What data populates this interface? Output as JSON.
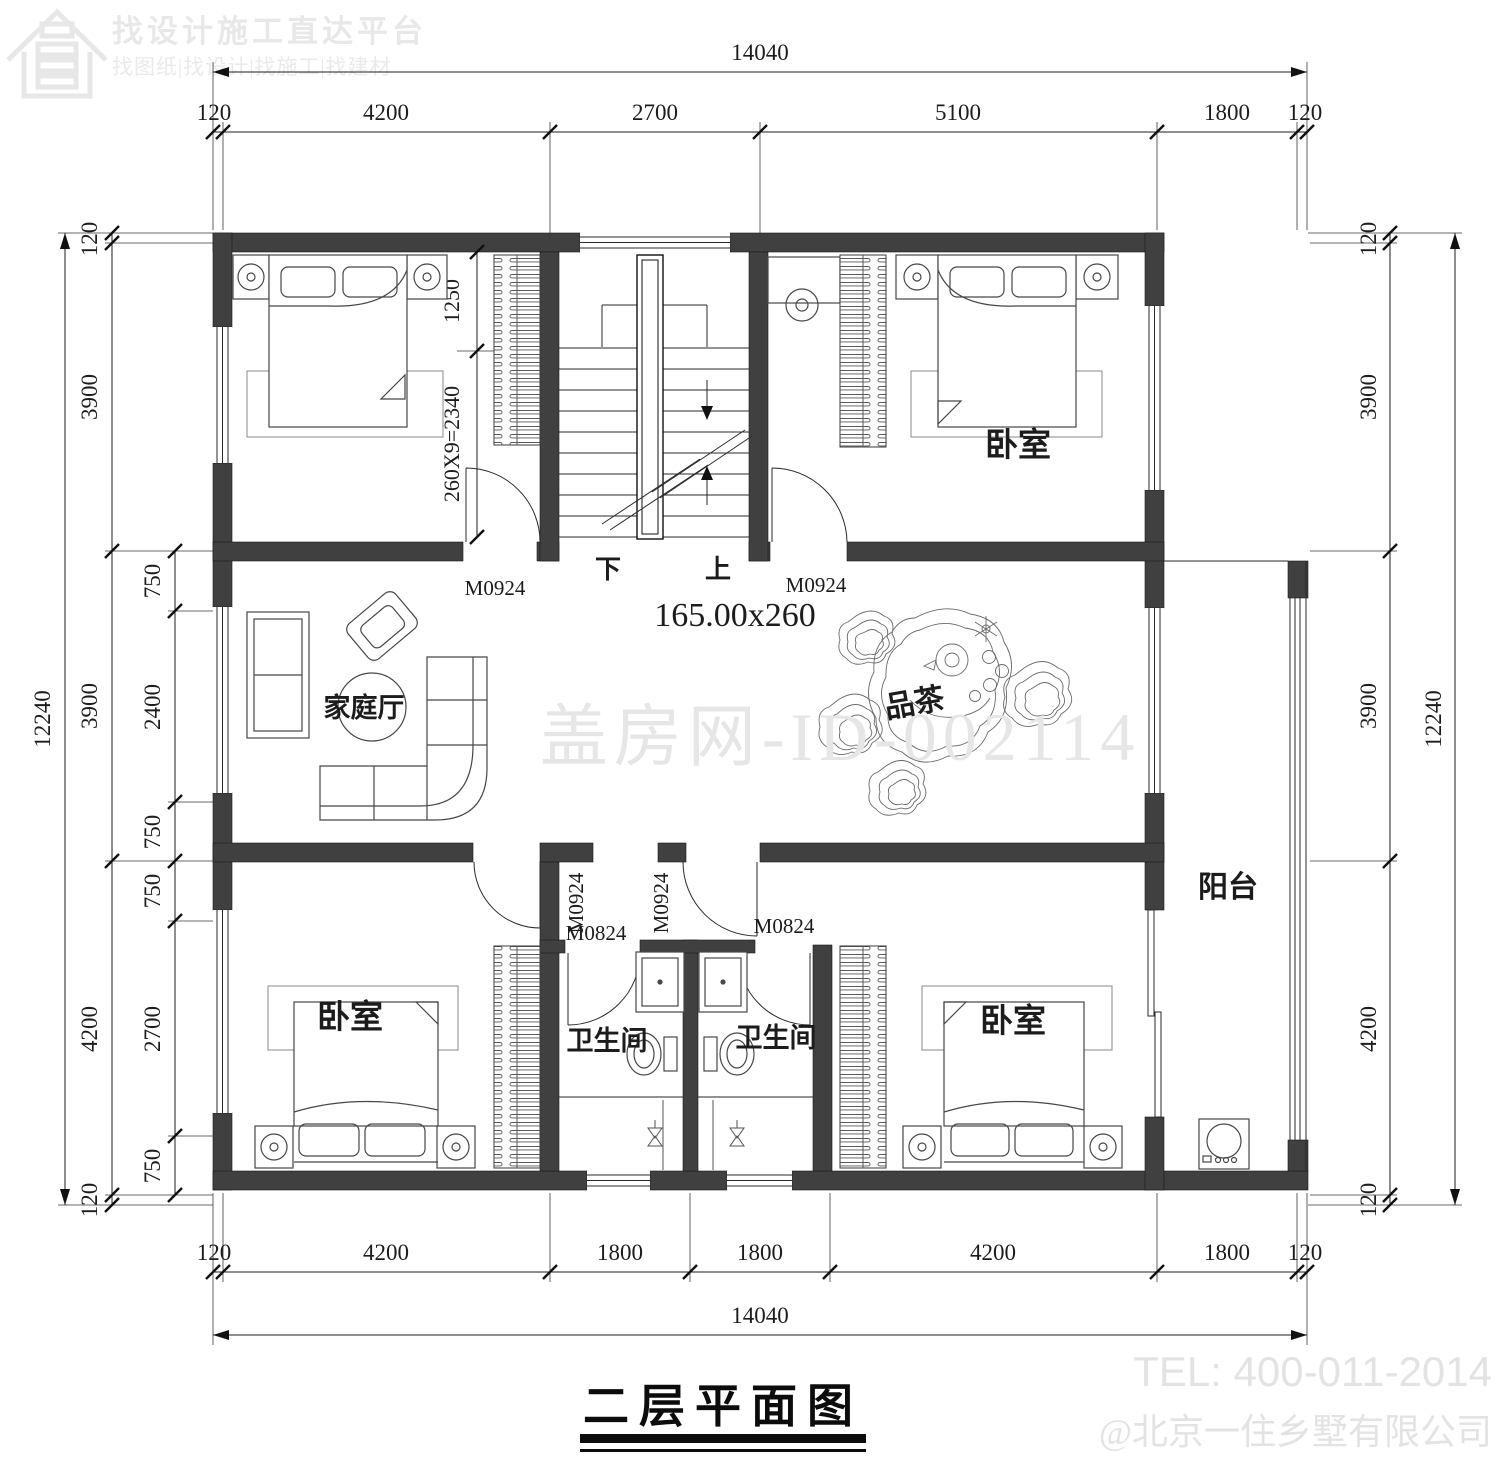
{
  "logo": {
    "title": "找设计施工直达平台",
    "subtitle": "找图纸|找设计|找施工|找建材"
  },
  "plan": {
    "note": "165.00x260",
    "rooms": {
      "bedroom_top_right": "卧室",
      "bedroom_bottom_left": "卧室",
      "bedroom_bottom_right": "卧室",
      "family_hall": "家庭厅",
      "tea_area": "品茶",
      "balcony": "阳台",
      "bath_left": "卫生间",
      "bath_right": "卫生间"
    },
    "stairs": {
      "down": "下",
      "up": "上",
      "landing_dim": "1250",
      "run_dim": "260X9=2340"
    },
    "doors": {
      "m0924_a": "M0924",
      "m0924_b": "M0924",
      "m0924_c": "M0924",
      "m0924_d": "M0924",
      "m0824_a": "M0824",
      "m0824_b": "M0824"
    }
  },
  "dims": {
    "top_total": "14040",
    "top": [
      "120",
      "4200",
      "2700",
      "5100",
      "1800",
      "120"
    ],
    "bottom": [
      "120",
      "4200",
      "1800",
      "1800",
      "4200",
      "1800",
      "120"
    ],
    "bottom_total": "14040",
    "left_total": "12240",
    "left_main": [
      "120",
      "3900",
      "3900",
      "4200",
      "120"
    ],
    "left_inner": [
      "750",
      "2400",
      "750",
      "750",
      "2700",
      "750"
    ],
    "right_main": [
      "120",
      "3900",
      "3900",
      "4200",
      "120"
    ],
    "right_total": "12240"
  },
  "watermark": {
    "center": "盖房网-ID-002114",
    "tel": "TEL: 400-011-2014",
    "company": "@北京一住乡墅有限公司"
  },
  "footer": {
    "title": "二层平面图"
  },
  "colors": {
    "wall": "#404040",
    "line": "#1c1c1c",
    "watermark": "#e6e6e6"
  }
}
